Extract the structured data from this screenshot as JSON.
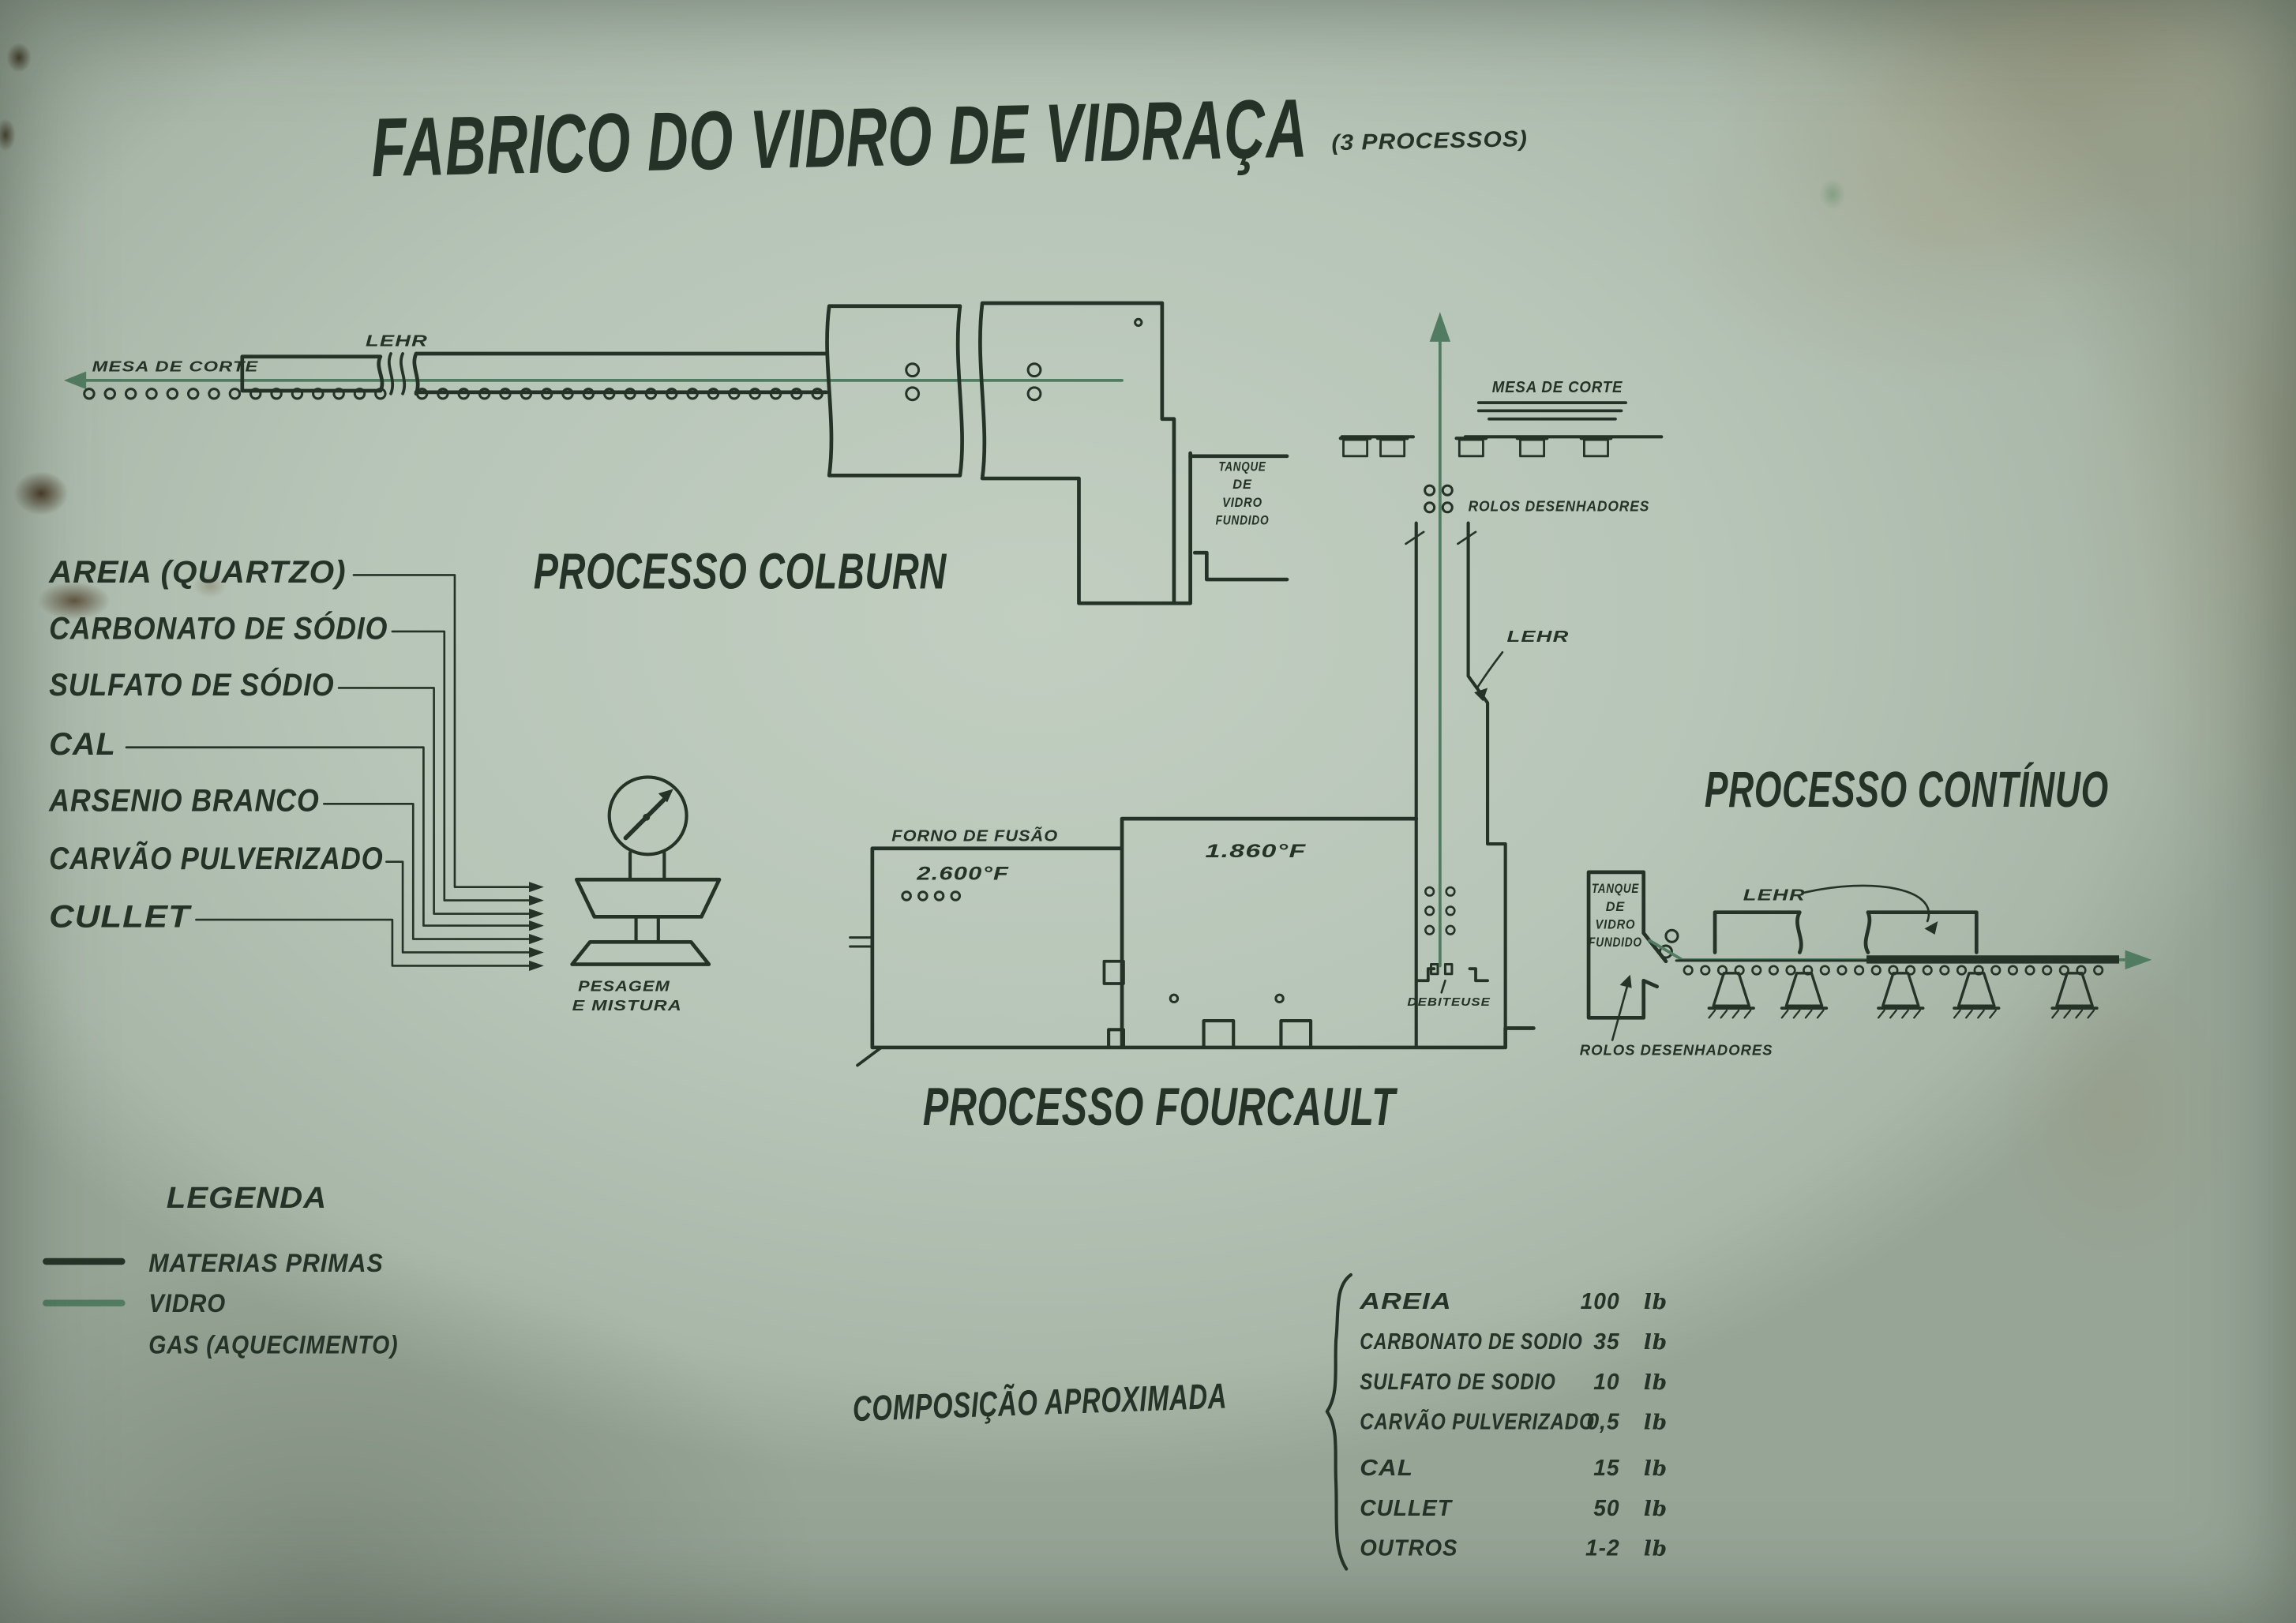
{
  "colors": {
    "paper": "#b7c5b8",
    "ink": "#243227",
    "glass": "#527c61"
  },
  "title": {
    "main": "FABRICO DO VIDRO DE VIDRAÇA",
    "suffix": "(3 PROCESSOS)"
  },
  "materials": {
    "items": [
      {
        "label": "AREIA (QUARTZO)"
      },
      {
        "label": "CARBONATO DE SÓDIO"
      },
      {
        "label": "SULFATO DE SÓDIO"
      },
      {
        "label": "CAL"
      },
      {
        "label": "ARSENIO BRANCO"
      },
      {
        "label": "CARVÃO PULVERIZADO"
      },
      {
        "label": "CULLET"
      }
    ]
  },
  "weigh_station": {
    "line1": "PESAGEM",
    "line2": "E MISTURA"
  },
  "colburn": {
    "title": "PROCESSO COLBURN",
    "mesa_de_corte": "MESA DE CORTE",
    "lehr": "LEHR",
    "tank_lines": [
      "TANQUE",
      "DE",
      "VIDRO",
      "FUNDIDO"
    ]
  },
  "fourcault": {
    "title": "PROCESSO FOURCAULT",
    "forno": "FORNO DE FUSÃO",
    "temp_left": "2.600°F",
    "temp_right": "1.860°F",
    "mesa_de_corte": "MESA DE CORTE",
    "rolos": "ROLOS DESENHADORES",
    "lehr": "LEHR",
    "debiteuse": "DEBITEUSE"
  },
  "continuo": {
    "title": "PROCESSO CONTÍNUO",
    "tank_lines": [
      "TANQUE",
      "DE",
      "VIDRO",
      "FUNDIDO"
    ],
    "lehr": "LEHR",
    "rolos": "ROLOS DESENHADORES"
  },
  "legend": {
    "title": "LEGENDA",
    "items": [
      {
        "swatch": "materias-primas",
        "label": "MATERIAS PRIMAS"
      },
      {
        "swatch": "vidro",
        "label": "VIDRO"
      },
      {
        "swatch": "none",
        "label": "GAS (AQUECIMENTO)"
      }
    ]
  },
  "composition": {
    "heading": "COMPOSIÇÃO APROXIMADA",
    "rows": [
      {
        "name": "AREIA",
        "value": "100",
        "unit": "lb"
      },
      {
        "name": "CARBONATO DE SODIO",
        "value": "35",
        "unit": "lb"
      },
      {
        "name": "SULFATO DE SODIO",
        "value": "10",
        "unit": "lb"
      },
      {
        "name": "CARVÃO PULVERIZADO",
        "value": "0,5",
        "unit": "lb"
      },
      {
        "name": "CAL",
        "value": "15",
        "unit": "lb"
      },
      {
        "name": "CULLET",
        "value": "50",
        "unit": "lb"
      },
      {
        "name": "OUTROS",
        "value": "1-2",
        "unit": "lb"
      }
    ]
  }
}
